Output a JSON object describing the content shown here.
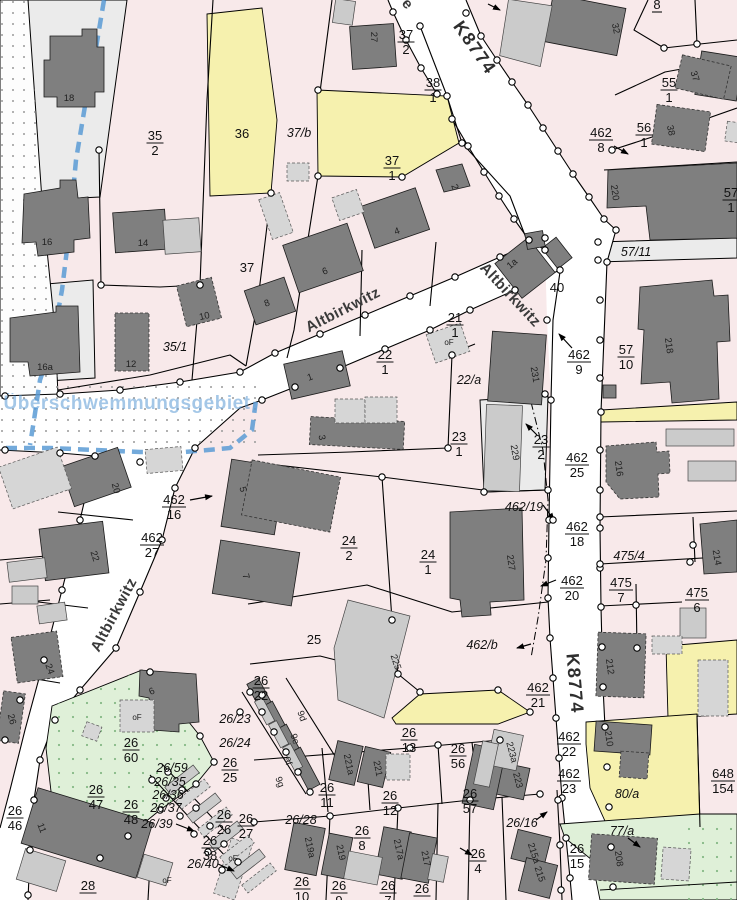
{
  "colors": {
    "parcel_pink": "#f8e9ea",
    "road_white": "#ffffff",
    "building_dark": "#7f7f7f",
    "building_light": "#cbcbcb",
    "parcel_yellow": "#f6f1ae",
    "parcel_green": "#dff0d8",
    "parcel_gray": "#ebebeb",
    "flood_blue": "#5b9bd5",
    "line_black": "#000000"
  },
  "labels": {
    "e_street": "e",
    "k8774_top": "K8774",
    "k8774_bottom": "K8774",
    "alt1": "Altbirkwitz",
    "alt2": "Altbirkwitz",
    "alt3": "Altbirkwitz",
    "flood": "Überschwemmungsgebiet",
    "f35_2": {
      "n": "35",
      "d": "2"
    },
    "f37_2": {
      "n": "37",
      "d": "2"
    },
    "f38_1": {
      "n": "38",
      "d": "1"
    },
    "f37_1": {
      "n": "37",
      "d": "1"
    },
    "f8": {
      "n": "8",
      "d": ""
    },
    "f55_1": {
      "n": "55",
      "d": "1"
    },
    "f56_1": {
      "n": "56",
      "d": "1"
    },
    "f462_8": {
      "n": "462",
      "d": "8"
    },
    "f57_1": {
      "n": "57",
      "d": "1"
    },
    "f21_1": {
      "n": "21",
      "d": "1"
    },
    "f22_1": {
      "n": "22",
      "d": "1"
    },
    "f462_9": {
      "n": "462",
      "d": "9"
    },
    "f57_10": {
      "n": "57",
      "d": "10"
    },
    "f23_1": {
      "n": "23",
      "d": "1"
    },
    "f23_2": {
      "n": "23",
      "d": "2"
    },
    "f462_25": {
      "n": "462",
      "d": "25"
    },
    "f462_16": {
      "n": "462",
      "d": "16"
    },
    "f462_27": {
      "n": "462",
      "d": "27"
    },
    "f24_2": {
      "n": "24",
      "d": "2"
    },
    "f24_1": {
      "n": "24",
      "d": "1"
    },
    "f462_18": {
      "n": "462",
      "d": "18"
    },
    "f475_7": {
      "n": "475",
      "d": "7"
    },
    "f475_6": {
      "n": "475",
      "d": "6"
    },
    "f462_20": {
      "n": "462",
      "d": "20"
    },
    "f462_21": {
      "n": "462",
      "d": "21"
    },
    "f462_22": {
      "n": "462",
      "d": "22"
    },
    "f462_23": {
      "n": "462",
      "d": "23"
    },
    "f26_22": {
      "n": "26",
      "d": "22"
    },
    "f26_25": {
      "n": "26",
      "d": "25"
    },
    "f26_60": {
      "n": "26",
      "d": "60"
    },
    "f26_47": {
      "n": "26",
      "d": "47"
    },
    "f26_48": {
      "n": "26",
      "d": "48"
    },
    "f26_46": {
      "n": "26",
      "d": "46"
    },
    "f26_38": {
      "n": "26",
      "d": "38"
    },
    "f26_26": {
      "n": "26",
      "d": "26"
    },
    "f26_27": {
      "n": "26",
      "d": "27"
    },
    "f26_11": {
      "n": "26",
      "d": "11"
    },
    "f26_12": {
      "n": "26",
      "d": "12"
    },
    "f26_13": {
      "n": "26",
      "d": "13"
    },
    "f26_56": {
      "n": "26",
      "d": "56"
    },
    "f26_57": {
      "n": "26",
      "d": "57"
    },
    "f26_8": {
      "n": "26",
      "d": "8"
    },
    "f26_4": {
      "n": "26",
      "d": "4"
    },
    "f26_15": {
      "n": "26",
      "d": "15"
    },
    "f26_10": {
      "n": "26",
      "d": "10"
    },
    "f26_9": {
      "n": "26",
      "d": "9"
    },
    "f26_7": {
      "n": "26",
      "d": "7"
    },
    "f26_x": {
      "n": "26",
      "d": ""
    },
    "f648_154": {
      "n": "648",
      "d": "154"
    },
    "f28": {
      "n": "28",
      "d": ""
    },
    "p36": "36",
    "p37": "37",
    "p25": "25",
    "p40": "40",
    "i37b": "37/b",
    "i35_1": "35/1",
    "i22a": "22/a",
    "i57_11": "57/11",
    "i462_19": "462/19",
    "i475_4": "475/4",
    "i462b": "462/b",
    "i26_23": "26/23",
    "i26_24": "26/24",
    "i26_59": "26/59",
    "i26_35": "26/35",
    "i26_36": "26/36",
    "i26_37": "26/37",
    "i26_39": "26/39",
    "i26_40": "26/40",
    "i26_28": "26/28",
    "i26_16": "26/16",
    "i80a": "80/a",
    "i77a": "77/a",
    "b18": "18",
    "b16": "16",
    "b14": "14",
    "b12": "12",
    "b10": "10",
    "b16a": "16a",
    "b27": "27",
    "b32": "32",
    "b37": "37",
    "b38": "38",
    "b220": "220",
    "b218": "218",
    "b216": "216",
    "b214": "214",
    "b212": "212",
    "b210": "210",
    "b208": "208",
    "b231": "231",
    "b229": "229",
    "b227": "227",
    "b225": "225",
    "b223a": "223a",
    "b223": "223",
    "b215a": "215a",
    "b215": "215",
    "b221a": "221a",
    "b221": "221",
    "b219a": "219a",
    "b219": "219",
    "b217a": "217a",
    "b217": "217",
    "b1a": "1a",
    "b1": "1",
    "b2": "2",
    "b3": "3",
    "b4": "4",
    "b5": "5",
    "b6": "6",
    "b7": "7",
    "b8": "8",
    "b6b": "6",
    "b24": "24",
    "b26": "26",
    "b11": "11",
    "b20": "20",
    "b22": "22",
    "b9d": "9d",
    "b9e": "9e",
    "b9f": "9f",
    "b9g": "9g",
    "of1": "oF",
    "of2": "oF",
    "of3": "oF",
    "of4": "oF"
  }
}
